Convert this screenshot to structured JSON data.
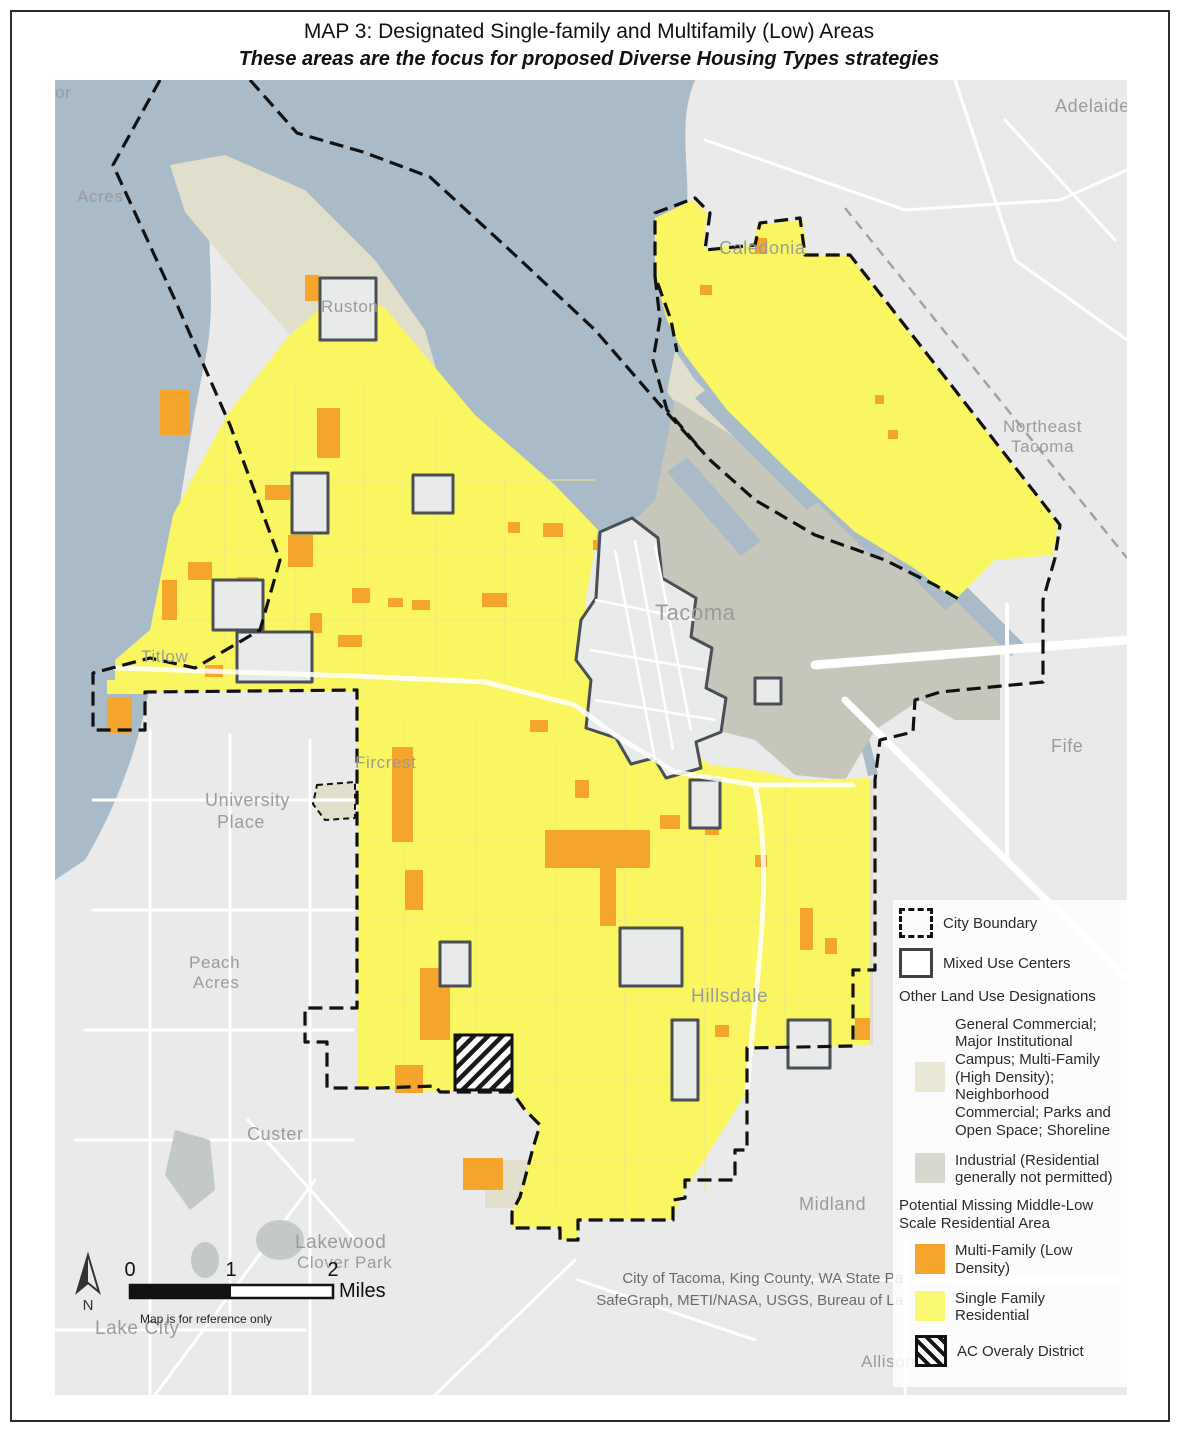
{
  "title": "MAP 3: Designated Single-family and Multifamily (Low) Areas",
  "subtitle": "These areas are the focus for proposed Diverse Housing Types strategies",
  "colors": {
    "water": "#a9bbc9",
    "land_outside": "#e9eae9",
    "other_land_use": "#e1decb",
    "industrial": "#c6c7ba",
    "single_family": "#faf661",
    "multi_family": "#f5a42c",
    "mixed_use_fill": "#e9eaea",
    "mixed_use_outline": "#4a4f55",
    "city_boundary": "#111111",
    "road": "#ffffff",
    "label": "#9b9b9b",
    "legend_beige": "#eae8d6",
    "legend_industrial": "#d6d7cd",
    "legend_yellow": "#fbf873"
  },
  "map": {
    "labels": [
      {
        "text": "or"
      },
      {
        "text": "Acres"
      },
      {
        "text": "Ruston"
      },
      {
        "text": "Adelaide"
      },
      {
        "text": "Caledonia"
      },
      {
        "text": "Northeast"
      },
      {
        "text": "Tacoma"
      },
      {
        "text": "Tacoma"
      },
      {
        "text": "Titlow"
      },
      {
        "text": "Fife"
      },
      {
        "text": "University"
      },
      {
        "text": "Place"
      },
      {
        "text": "Fircrest"
      },
      {
        "text": "Peach"
      },
      {
        "text": "Acres"
      },
      {
        "text": "Hillsdale"
      },
      {
        "text": "Custer"
      },
      {
        "text": "Midland"
      },
      {
        "text": "Lakewood"
      },
      {
        "text": "Clover Park"
      },
      {
        "text": "Lake City"
      },
      {
        "text": "Allison"
      }
    ]
  },
  "legend": {
    "city_boundary_label": "City Boundary",
    "mixed_use_label": "Mixed Use Centers",
    "other_header": "Other Land Use Designations",
    "other_general_label": "General Commercial; Major Institutional Campus; Multi-Family (High Density); Neighborhood Commercial; Parks and Open Space; Shoreline",
    "industrial_label": "Industrial (Residential generally not permitted)",
    "potential_header": "Potential Missing Middle-Low Scale Residential Area",
    "multi_family_label": "Multi-Family (Low Density)",
    "single_family_label": "Single Family Residential",
    "ac_overlay_label": "AC Overaly District"
  },
  "scale": {
    "tick0": "0",
    "tick1": "1",
    "tick2": "2",
    "unit": "Miles",
    "north": "N",
    "disclaimer": "Map is for reference only"
  },
  "attribution": {
    "line1": "City of Tacoma, King County, WA State Pa",
    "line2": "SafeGraph, METI/NASA, USGS, Bureau of La"
  }
}
